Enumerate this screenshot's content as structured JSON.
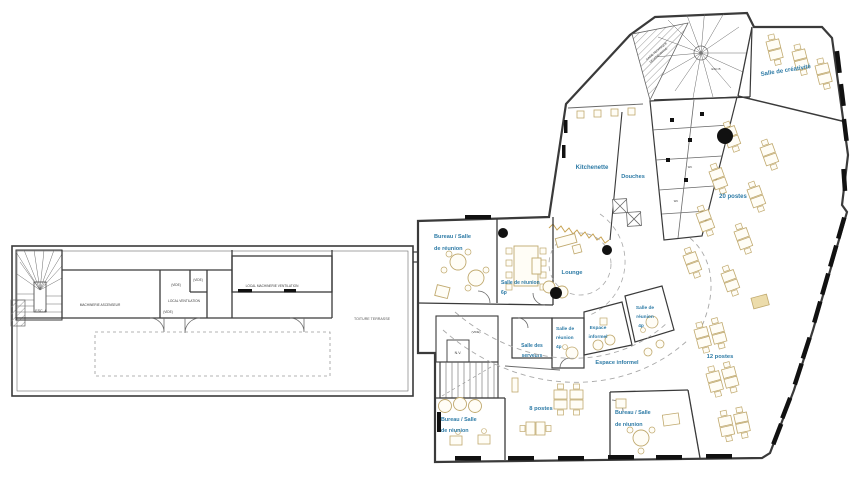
{
  "colors": {
    "label_blue": "#2e7ba6",
    "cad_text": "#3a3a3a",
    "wall": "#3a3a3a",
    "furniture_tan": "#c0a96e",
    "hatch_gray": "#8a8a8a"
  },
  "labels": {
    "esc_a": "ESC. A",
    "machinerie_ascenseur": "MACHINERIE ASCENSEUR",
    "vide": "(VIDE)",
    "local_ventilation": "LOCAL VENTILATION",
    "local_machinerie_ventilation": "LOCAL MACHINERIE VENTILATION",
    "toiture_terrasse": "TOITURE TERRASSE",
    "gaine_l1": "GAINE TECHNIQUE",
    "gaine_l2": "DESENFUMAGE",
    "esc_b": "ESC B",
    "salle_creativite": "Salle de créativité",
    "kitchenette": "Kitchenette",
    "douches": "Douches",
    "postes_20": "20 postes",
    "bureau_top_l1": "Bureau / Salle",
    "bureau_top_l2": "de réunion",
    "reunion6_l1": "Salle de réunion",
    "reunion6_l2": "6p",
    "lounge": "Lounge",
    "serveurs_l1": "Salle des",
    "serveurs_l2": "serveurs",
    "reunion4a_l1": "Salle de",
    "reunion4a_l2": "réunion",
    "reunion4a_l3": "4p",
    "espace1_l1": "Espace",
    "espace1_l2": "informel",
    "reunion4b_l1": "Salle de",
    "reunion4b_l2": "réunion",
    "reunion4b_l3": "4p",
    "espace2": "Espace informel",
    "postes_8": "8 postes",
    "bureau_bl_l1": "Bureau / Salle",
    "bureau_bl_l2": "de réunion",
    "bureau_br_l1": "Bureau / Salle",
    "bureau_br_l2": "de réunion",
    "postes_12": "12 postes",
    "nv": "N.V.",
    "wc": "WC"
  }
}
